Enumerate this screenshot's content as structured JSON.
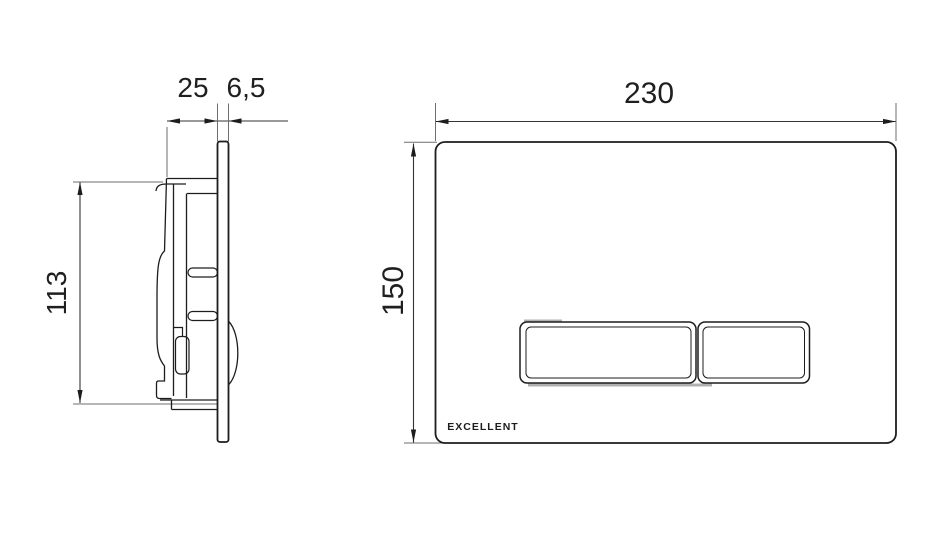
{
  "drawing": {
    "type": "technical-dimension-drawing",
    "product": "wall flush plate with mounting mechanism",
    "colors": {
      "background": "#ffffff",
      "line": "#1d1d1d",
      "dimension": "#333333",
      "shade": "#b0b0b0"
    },
    "side_view": {
      "depth_label": "25",
      "plate_thickness_label": "6,5",
      "height_label": "113"
    },
    "front_view": {
      "width_label": "230",
      "height_label": "150",
      "brand_logo": "EXCELLENT"
    }
  }
}
